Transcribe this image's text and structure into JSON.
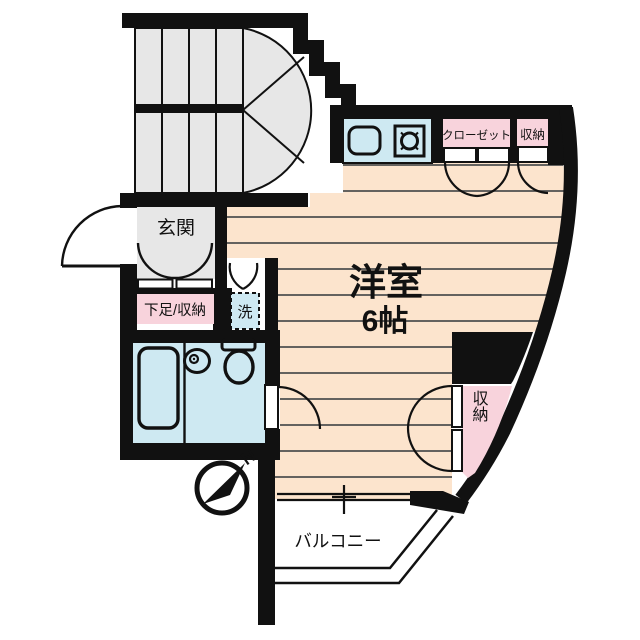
{
  "title": "apartment-floor-plan",
  "labels": {
    "entrance": "玄関",
    "shoe_storage": "下足/収納",
    "washer": "洗",
    "room_name": "洋室",
    "room_size": "6帖",
    "closet": "クローゼット",
    "storage_top": "収納",
    "storage_right": "収納",
    "balcony": "バルコニー",
    "compass_north": "N"
  },
  "colors": {
    "wall": "#111111",
    "room_floor": "#fce4cd",
    "floor_line": "#4f4f4f",
    "stair_gray": "#e7e7e7",
    "label_pink": "#f8d3dc",
    "water_blue": "#cee9f2",
    "background": "#ffffff"
  }
}
